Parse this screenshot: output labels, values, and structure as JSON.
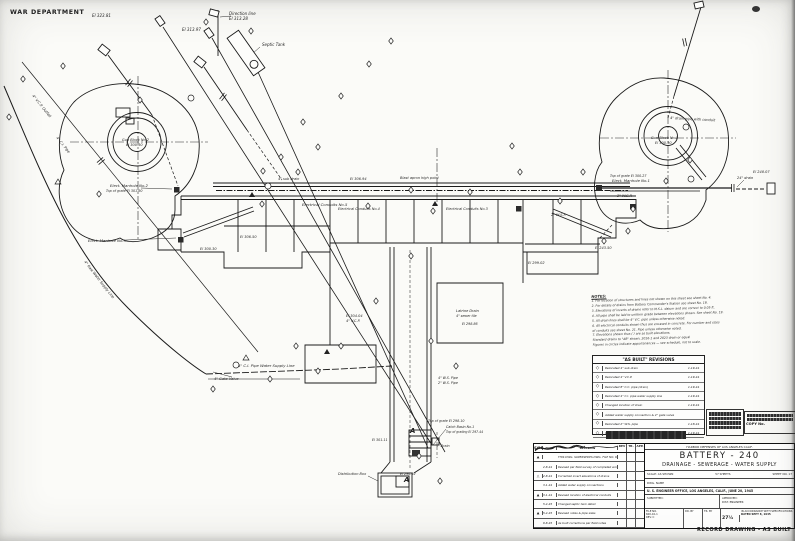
{
  "sheet": {
    "war_department": "WAR DEPARTMENT",
    "record_note": "RECORD DRAWING - AS BUILT"
  },
  "callouts": {
    "c_direction": "Direction line",
    "c_dir_el": "El 313.28",
    "c_septic": "Septic Tank",
    "c_el32381": "El 323.81",
    "c_el31397": "El 313.97",
    "c_outfall": "4\" V.C.P. Outfall",
    "c_cipipe": "4\" C.I. Pipe",
    "c_gun2": "Gun Block No.2",
    "c_gun2_el": "El 300.30",
    "c_mh2": "Elect. Manhole No.2",
    "c_mh2_grate": "Top of grate El 301.80",
    "c_mh3": "Elect. Manhole No.3",
    "c_gun1": "Gun Block No.1",
    "c_gun1_el": "El 300.30",
    "c_drainpipe": "4\" drain pipe with conduit",
    "c_mh1_grate": "Top of grate El 300.27",
    "c_mh1": "Elect. Manhole No.1",
    "c_wsp2": "2\" W.S.P.",
    "c_drain24": "24\" drain",
    "c_el24807": "El 248.07",
    "c_subdrain": "4\" sub drain",
    "c_el30694": "El 306.94",
    "c_blast": "Blast apron high point",
    "c_cond5": "Electrical Conduits No.5",
    "c_cond4": "Electrical Conduits No.4",
    "c_cond3": "Electrical Conduits No.3",
    "c_el30650": "El 306.50",
    "c_el30030": "El 300.30",
    "c_el30404": "El 304.04",
    "c_vcp4": "4\" V.C.P.",
    "c_latrine": "Latrine Drain",
    "c_sewertile": "4\" sewer tile",
    "c_el29886": "El 298.86",
    "c_ws4": "4\" W.S. Pipe",
    "c_ws2": "2\" W.S. Pipe",
    "c_grate29810": "Top of grate El 298.10",
    "c_cb1": "Catch Basin No.1",
    "c_grating29744": "Top of grating El 297.44",
    "c_el30111": "El 301.11",
    "c_drain4": "4\" Drain",
    "c_el29692": "El 296.92",
    "c_distbox": "Distribution Box",
    "c_wsline": "4\" C.I. Pipe Water Supply Line",
    "c_gatevalve": "4\" Gate Valve",
    "c_rawwater": "4\" Raw Water Supply Line",
    "c_wsp2b": "2\" W.S.P.",
    "c_el29902": "El 299.02",
    "c_el24350": "El 243.50",
    "c_a": "A"
  },
  "notes": {
    "title": "NOTES:",
    "lines": [
      "1. For location of structures and lines not shown on this sheet see sheet No. 4.",
      "2. For details of drains from Battery Commander's Station see sheet No. 18.",
      "3. Elevations of inverts of drains refer to M.S.L. datum and are correct to 0.05 ft.",
      "4. All pipe shall be laid to uniform grade between elevations shown. See sheet No. 19.",
      "5. All drain lines shall be 4\" V.C. pipe unless otherwise noted.",
      "6. All electrical conduits shown thus are encased in concrete. For number and sizes",
      "    of conduits see sheet No. 21. Pipe unless otherwise noted.",
      "7. Elevations shown thus ( ) are as built elevations.",
      "Standard drains to \"AB\" shown, 2016-1 and 2023 drain or equal",
      "Figures in circles indicate appurtenances — see schedule, not to scale."
    ]
  },
  "as_built_revisions": {
    "title": "\"AS BUILT\" REVISIONS",
    "rows": [
      {
        "sym": "◇",
        "text": "Relocated 4\" sub drain",
        "date": "1-19-44"
      },
      {
        "sym": "◇",
        "text": "Relocated 4\" V.C.P.",
        "date": "1-19-44"
      },
      {
        "sym": "◇",
        "text": "Relocated 8\" C.C. pipe (drain)",
        "date": "1-19-44"
      },
      {
        "sym": "◇",
        "text": "Relocated 4\" C.I. pipe water supply line",
        "date": "1-19-44"
      },
      {
        "sym": "◇",
        "text": "Changed location of drain",
        "date": "1-19-44"
      },
      {
        "sym": "◇",
        "text": "Added water supply connection & 4\" gate valve",
        "date": ""
      },
      {
        "sym": "◇",
        "text": "Relocated 2\" W.S. pipe",
        "date": "1-18-44"
      },
      {
        "sym": "◇",
        "text": "Changed location of electrical manhole No.7",
        "date": "1-19-44"
      }
    ]
  },
  "stamps": {
    "copy_no": "COPY No."
  },
  "title_block": {
    "district": "HARBOR DEFENSES OF LOS ANGELES CALIF.",
    "battery": "BATTERY - 240",
    "subtitle": "DRAINAGE - SEWERAGE - WATER SUPPLY",
    "scale": "SCALE: AS SHOWN",
    "sheets": "57 SHEETS",
    "sheet_no": "SHEET NO. 17",
    "name_label": "DWG. NAME",
    "office_line": "U. S. ENGINEER OFFICE, LOS ANGELES, CALIF., JUNE 20, 1945",
    "submitted_label": "SUBMITTED:",
    "approved_label": "APPROVED:",
    "approved_title": "DIST. ENGINEER",
    "file_label": "FILE NO.",
    "file_no": "600-10-1",
    "rev": "REV. C",
    "dr_by": "DR. BY",
    "tr_by": "TR. BY",
    "half": "27½",
    "spec_line": "IN ACCORDANCE WITH SPECIFICATIONS",
    "dated": "DATED SEPT 8, 1945",
    "rev_table": {
      "headers": [
        "SYM",
        "DATE",
        "REVISION",
        "REV",
        "TR.",
        "APP."
      ],
      "rows": [
        {
          "sym": "▲",
          "date": "",
          "text": "THIS DWG. SUPERSEDES DWG. FILE NO. 600-45/233"
        },
        {
          "sym": "",
          "date": "2-8-44",
          "text": "Revised per field survey of completed work"
        },
        {
          "sym": "△",
          "date": "2-8-44",
          "text": "Corrected invert elevations of drains"
        },
        {
          "sym": "",
          "date": "3-1-44",
          "text": "Added water supply connections"
        },
        {
          "sym": "▲",
          "date": "3-1-44",
          "text": "Revised location of electrical conduits"
        },
        {
          "sym": "",
          "date": "5-4-45",
          "text": "Changed septic tank detail"
        },
        {
          "sym": "▲",
          "date": "5-4-45",
          "text": "Revised notes & pipe sizes"
        },
        {
          "sym": "",
          "date": "9-8-45",
          "text": "As built corrections per field notes"
        }
      ]
    }
  }
}
